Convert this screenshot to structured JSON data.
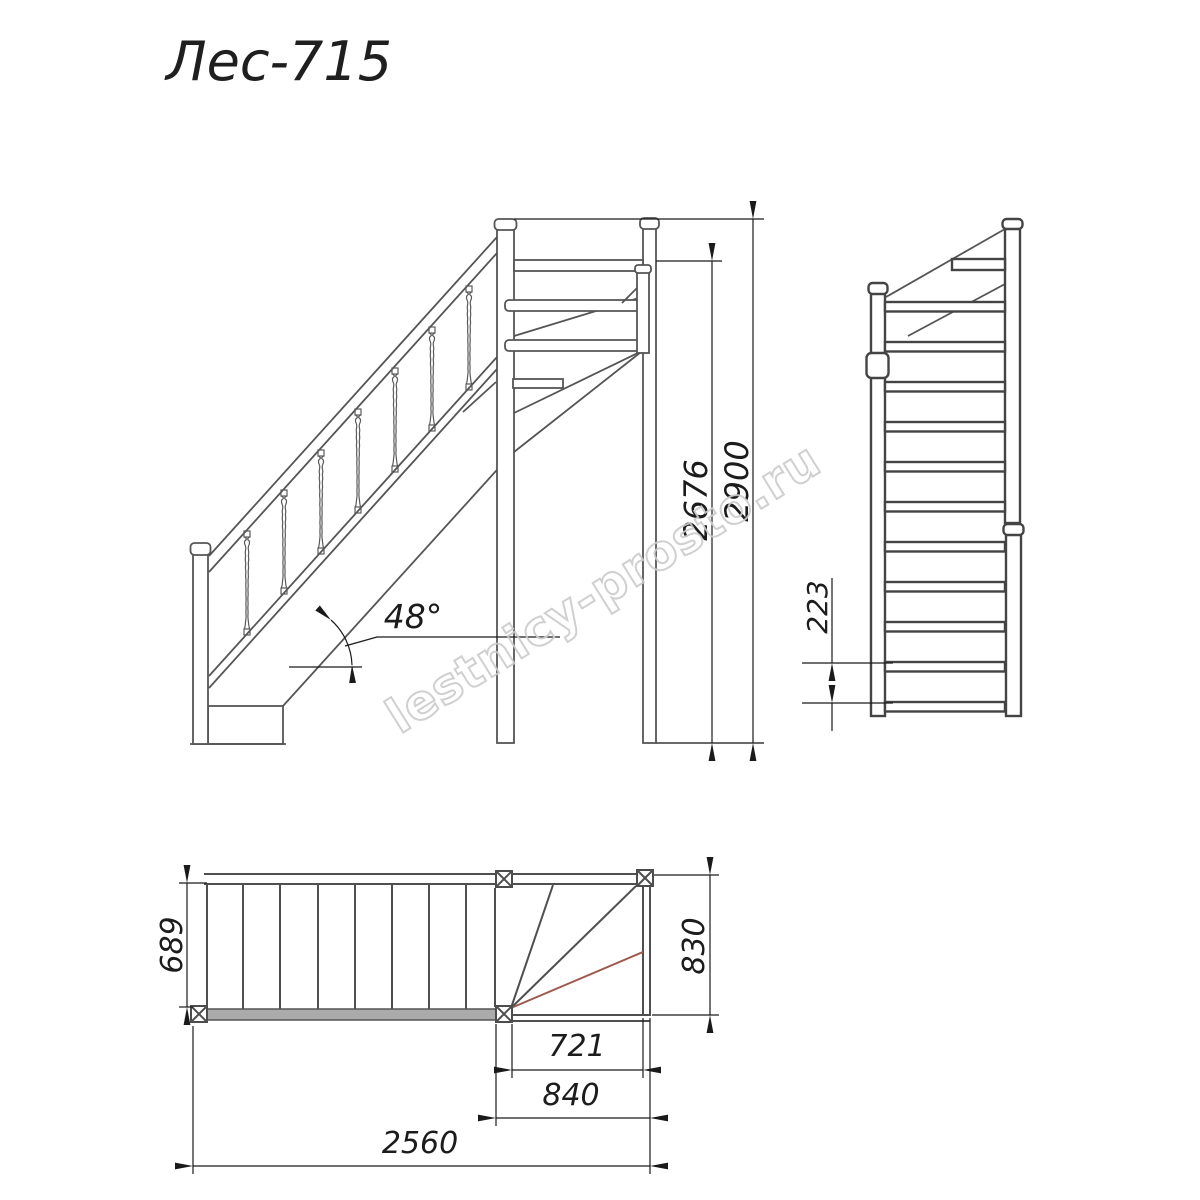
{
  "title": "Лес-715",
  "watermark": "lestnicy-prosto.ru",
  "elevation": {
    "slope_angle": "48°",
    "total_height": "2900",
    "clear_height": "2676"
  },
  "front_view": {
    "riser_height": "223"
  },
  "plan_view": {
    "flight_width": "689",
    "landing_depth": "830",
    "winder_inner_run": "721",
    "winder_outer_run": "840",
    "total_run": "2560"
  },
  "colors": {
    "line": "#4f4f4f",
    "dimension": "#1a1a1a",
    "fan_accent": "#a0584c",
    "watermark": "#cbcbcb",
    "background": "#ffffff"
  }
}
